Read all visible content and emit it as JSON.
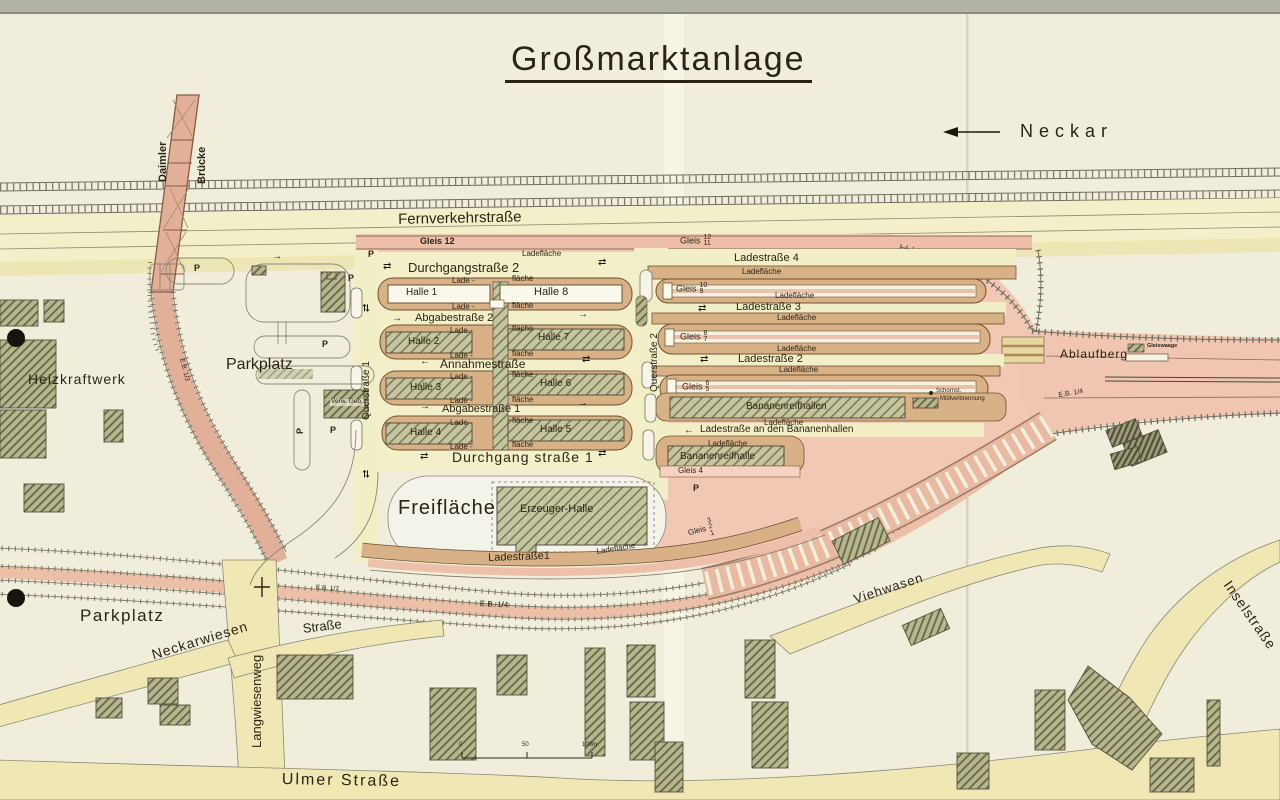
{
  "title": "Großmarktanlage",
  "river": {
    "name": "Neckar"
  },
  "bridge": {
    "name_line1": "Daimler",
    "name_line2": "Brücke"
  },
  "roads": {
    "fernverkehrstrasse": "Fernverkehrstraße",
    "durchgangstrasse2": "Durchgangstraße 2",
    "abgabestrasse2": "Abgabestraße 2",
    "annahmestrasse": "Annahmestraße",
    "abgabestrasse1": "Abgabestraße 1",
    "durchgangstrasse1": "Durchgang straße 1",
    "querstrasse1": "Querstraße 1",
    "querstrasse2": "Querstraße 2",
    "ladestrasse4": "Ladestraße 4",
    "ladestrasse3": "Ladestraße 3",
    "ladestrasse2": "Ladestraße 2",
    "ladestrasse1": "Ladestraße1",
    "ladestrasse_bananenhallen": "Ladestraße an den Bananenhallen",
    "neckarwiesen": "Neckarwiesen",
    "langwiesenweg": "Langwiesenweg",
    "strasse": "Straße",
    "viehwasen": "Viehwasen",
    "inselstrasse": "Inselstraße",
    "ulmer_strasse": "Ulmer Straße"
  },
  "halls": {
    "halle1": "Halle 1",
    "halle2": "Halle 2",
    "halle3": "Halle 3",
    "halle4": "Halle 4",
    "halle5": "Halle 5",
    "halle6": "Halle 6",
    "halle7": "Halle 7",
    "halle8": "Halle 8",
    "erzeuger_halle": "Erzeuger-Halle",
    "bananenreifhallen": "Bananenreifhallen",
    "bananenreifhalle": "Bananenreifhalle",
    "verw_geb": "Verw. Geb."
  },
  "rail": {
    "gleis12": "Gleis 12",
    "gleis_word": "Gleis",
    "g12_11": {
      "top": "12",
      "bottom": "11"
    },
    "g10_9": {
      "top": "10",
      "bottom": "9"
    },
    "g8_7": {
      "top": "8",
      "bottom": "7"
    },
    "g6_5": {
      "top": "6",
      "bottom": "5"
    },
    "gleis4": "Gleis 4",
    "g3_2_1": {
      "top": "3",
      "mid": "2",
      "bottom": "1"
    },
    "ablaufberg": "Ablaufberg",
    "gleiswaage": "Gleiswaage",
    "eb_1_3": "E.B. 1/3",
    "eb_1_4": "E.B. 1/4",
    "eb_1_7": "E.B. 1/7"
  },
  "areas": {
    "ladeflaeche": "Ladefläche",
    "lade_prefix": "Lade -",
    "flaeche_suffix": "fläche",
    "freiflaeche": "Freifläche",
    "parkplatz": "Parkplatz",
    "parking_symbol": "P",
    "heizkraftwerk": "Heizkraftwerk",
    "schornstein": "Schornst.",
    "muellverbrennung": "Müllverbrennung"
  },
  "scale_bar": {
    "start": "0",
    "middle": "50",
    "end": "100m"
  },
  "icons": {
    "arrow_left": "←",
    "arrow_right": "→",
    "arrow_two_way": "⇄"
  },
  "colors": {
    "paper": "#f0eedb",
    "rail_pink": "#eec0aa",
    "road_yellow": "#efe8b4",
    "lade_tan": "#d8b286",
    "hall_olive": "#b7b78c",
    "ink": "#2b2416"
  }
}
